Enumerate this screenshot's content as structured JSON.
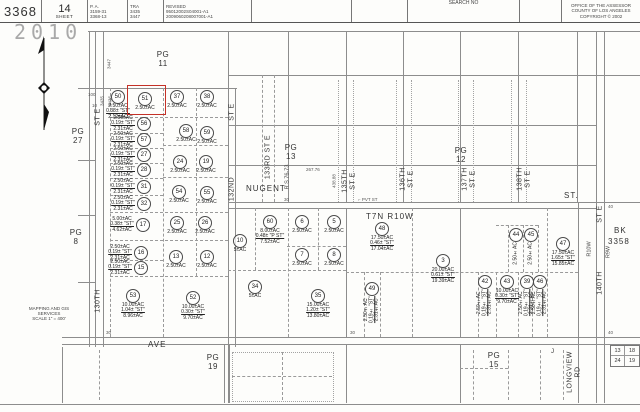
{
  "header": {
    "book": "3368",
    "sheet_num": "14",
    "sheet_word": "SHEET",
    "pa_label": "P. A.",
    "pa_lines": [
      "3159-31",
      "3368-13"
    ],
    "tra_label": "TRA",
    "tra_lines": [
      "3435",
      "3447"
    ],
    "revised_label": "REVISED",
    "revised_lines": [
      "95012002S04001-A1",
      "2009060208007001-A1"
    ],
    "search_label": "SEARCH NO",
    "office_lines": [
      "OFFICE OF THE ASSESSOR",
      "COUNTY OF LOS ANGELES",
      "COPYRIGHT © 2002"
    ]
  },
  "stamp": "2010",
  "compass_note": [
    "MAPPING AND GIS",
    "SERVICES",
    "SCALE 1\" = 400'"
  ],
  "pg_labels": [
    {
      "id": "pg-11",
      "l1": "PG",
      "l2": "11",
      "x": 163,
      "y": 50
    },
    {
      "id": "pg-27",
      "l1": "PG",
      "l2": "27",
      "x": 78,
      "y": 127
    },
    {
      "id": "pg-8",
      "l1": "PG",
      "l2": "8",
      "x": 76,
      "y": 228
    },
    {
      "id": "pg-13",
      "l1": "PG",
      "l2": "13",
      "x": 291,
      "y": 143
    },
    {
      "id": "pg-12",
      "l1": "PG",
      "l2": "12",
      "x": 461,
      "y": 146
    },
    {
      "id": "pg-19",
      "l1": "PG",
      "l2": "19",
      "x": 213,
      "y": 353
    },
    {
      "id": "pg-15",
      "l1": "PG",
      "l2": "15",
      "x": 494,
      "y": 351
    }
  ],
  "vlabels": [
    {
      "id": "130th-st-e-top",
      "lines": [
        "ST E"
      ],
      "x": 98,
      "y": 117,
      "cls": ""
    },
    {
      "id": "130th-st-e-name",
      "lines": [
        "130TH"
      ],
      "x": 98,
      "y": 301,
      "cls": ""
    },
    {
      "id": "tra-3447",
      "lines": [
        "3447"
      ],
      "x": 109,
      "y": 64,
      "cls": "tiny"
    },
    {
      "id": "tra-3435",
      "lines": [
        "3435"
      ],
      "x": 102,
      "y": 101,
      "cls": "tiny"
    },
    {
      "id": "tra-3436",
      "lines": [
        "3436"
      ],
      "x": 110,
      "y": 101,
      "cls": "tiny"
    },
    {
      "id": "132nd-st-e-top",
      "lines": [
        "ST E"
      ],
      "x": 232,
      "y": 112,
      "cls": ""
    },
    {
      "id": "132nd-st-e-name",
      "lines": [
        "132ND"
      ],
      "x": 232,
      "y": 189,
      "cls": ""
    },
    {
      "id": "133rd-st-e",
      "lines": [
        "133RD ST E"
      ],
      "x": 268,
      "y": 157,
      "cls": ""
    },
    {
      "id": "rs-76-73",
      "lines": [
        "R S 76-73"
      ],
      "x": 288,
      "y": 177,
      "cls": "small"
    },
    {
      "id": "dim-438",
      "lines": [
        "438.88"
      ],
      "x": 334,
      "y": 181,
      "cls": "tiny"
    },
    {
      "id": "135th-st-e",
      "lines": [
        "135TH",
        "ST E"
      ],
      "x": 349,
      "y": 181,
      "cls": ""
    },
    {
      "id": "136th-st-e",
      "lines": [
        "136TH",
        "ST E"
      ],
      "x": 407,
      "y": 179,
      "cls": ""
    },
    {
      "id": "137th-st-e",
      "lines": [
        "137TH",
        "ST E"
      ],
      "x": 469,
      "y": 179,
      "cls": ""
    },
    {
      "id": "138th-st-e",
      "lines": [
        "138TH",
        "ST E"
      ],
      "x": 524,
      "y": 179,
      "cls": ""
    },
    {
      "id": "140th-st-e-top",
      "lines": [
        "ST E"
      ],
      "x": 600,
      "y": 214,
      "cls": ""
    },
    {
      "id": "140th-st-e-name",
      "lines": [
        "140TH"
      ],
      "x": 600,
      "y": 283,
      "cls": ""
    },
    {
      "id": "r10w",
      "lines": [
        "R10W"
      ],
      "x": 590,
      "y": 249,
      "cls": "small"
    },
    {
      "id": "r9w",
      "lines": [
        "R9W"
      ],
      "x": 609,
      "y": 252,
      "cls": "small"
    },
    {
      "id": "longview-rd",
      "lines": [
        "LONGVIEW",
        "RD"
      ],
      "x": 574,
      "y": 372,
      "cls": ""
    }
  ],
  "hlabels": [
    {
      "id": "nugent-st",
      "text": "NUGENT",
      "x": 246,
      "y": 184,
      "cls": ""
    },
    {
      "id": "nugent-st-2",
      "text": "ST.",
      "x": 564,
      "y": 191,
      "cls": ""
    },
    {
      "id": "ave",
      "text": "AVE",
      "x": 148,
      "y": 340,
      "cls": ""
    },
    {
      "id": "t7n-r10w",
      "text": "T7N R10W",
      "x": 366,
      "y": 212,
      "cls": ""
    },
    {
      "id": "j-mark",
      "text": "J",
      "x": 551,
      "y": 349,
      "cls": "small"
    },
    {
      "id": "bk-label",
      "text": "BK",
      "x": 614,
      "y": 226,
      "cls": ""
    },
    {
      "id": "bk-number",
      "text": "3358",
      "x": 608,
      "y": 237,
      "cls": ""
    },
    {
      "id": "pvt-st",
      "text": "⌐ PVT ST",
      "x": 358,
      "y": 197,
      "cls": "tiny"
    },
    {
      "id": "dim-267",
      "text": "267.76",
      "x": 306,
      "y": 167,
      "cls": "tiny"
    },
    {
      "id": "tick-30-rs",
      "text": "30",
      "x": 284,
      "y": 197,
      "cls": "tiny"
    },
    {
      "id": "tick-40-a",
      "text": "40",
      "x": 608,
      "y": 204,
      "cls": "tiny"
    },
    {
      "id": "tick-40-b",
      "text": "40",
      "x": 608,
      "y": 330,
      "cls": "tiny"
    },
    {
      "id": "tick-30-a",
      "text": "30",
      "x": 106,
      "y": 330,
      "cls": "tiny"
    },
    {
      "id": "tick-30-b",
      "text": "30",
      "x": 350,
      "y": 330,
      "cls": "tiny"
    },
    {
      "id": "tick-100",
      "text": "100",
      "x": 88,
      "y": 92,
      "cls": "tiny"
    },
    {
      "id": "tick-10",
      "text": "10",
      "x": 92,
      "y": 103,
      "cls": "tiny"
    }
  ],
  "corner_box": {
    "tl": "13",
    "tr": "18",
    "bl": "24",
    "br": "19"
  },
  "highlight_color": "#c43127",
  "parcels": [
    {
      "n": "50",
      "cx": 118,
      "cy": 97,
      "mode": "below",
      "lines": [
        "2.50±AC",
        "0.38± \"ST\"",
        "2.12±AC"
      ]
    },
    {
      "n": "51",
      "cx": 145,
      "cy": 99,
      "mode": "below",
      "lines": [
        "2.50±AC"
      ],
      "red": [
        127,
        85,
        37,
        28
      ]
    },
    {
      "n": "37",
      "cx": 177,
      "cy": 97,
      "mode": "below",
      "lines": [
        "2.50±AC"
      ]
    },
    {
      "n": "38",
      "cx": 207,
      "cy": 97,
      "mode": "below",
      "lines": [
        "2.50±AC"
      ]
    },
    {
      "n": "56",
      "cx": 144,
      "cy": 124,
      "mode": "side",
      "lines": [
        "2.50±AC",
        "0.19± \"ST\"",
        "2.31±AC"
      ]
    },
    {
      "n": "58",
      "cx": 186,
      "cy": 131,
      "mode": "below",
      "lines": [
        "2.50±AC"
      ]
    },
    {
      "n": "59",
      "cx": 207,
      "cy": 133,
      "mode": "below",
      "lines": [
        "2.50±AC"
      ]
    },
    {
      "n": "57",
      "cx": 144,
      "cy": 140,
      "mode": "side",
      "lines": [
        "2.50±AC",
        "0.19± \"ST\"",
        "2.31±AC"
      ]
    },
    {
      "n": "27",
      "cx": 144,
      "cy": 155,
      "mode": "side",
      "lines": [
        "2.50±AC",
        "0.19± \"ST\"",
        "2.31±AC"
      ]
    },
    {
      "n": "24",
      "cx": 180,
      "cy": 162,
      "mode": "below",
      "lines": [
        "2.50±AC"
      ]
    },
    {
      "n": "19",
      "cx": 206,
      "cy": 162,
      "mode": "below",
      "lines": [
        "2.50±AC"
      ]
    },
    {
      "n": "28",
      "cx": 144,
      "cy": 170,
      "mode": "side",
      "lines": [
        "2.50±AC",
        "0.19± \"ST\"",
        "2.31±AC"
      ]
    },
    {
      "n": "31",
      "cx": 144,
      "cy": 187,
      "mode": "side",
      "lines": [
        "2.50±AC",
        "0.19± \"ST\"",
        "2.31±AC"
      ]
    },
    {
      "n": "54",
      "cx": 179,
      "cy": 192,
      "mode": "below",
      "lines": [
        "2.50±AC"
      ]
    },
    {
      "n": "55",
      "cx": 207,
      "cy": 193,
      "mode": "below",
      "lines": [
        "2.50±AC"
      ]
    },
    {
      "n": "32",
      "cx": 144,
      "cy": 204,
      "mode": "side",
      "lines": [
        "2.50±AC",
        "0.19± \"ST\"",
        "2.31±AC"
      ]
    },
    {
      "n": "17",
      "cx": 143,
      "cy": 225,
      "mode": "side",
      "lines": [
        "5.00±AC",
        "0.38± \"ST\"",
        "4.62±AC"
      ]
    },
    {
      "n": "25",
      "cx": 177,
      "cy": 223,
      "mode": "below",
      "lines": [
        "2.50±AC"
      ]
    },
    {
      "n": "26",
      "cx": 205,
      "cy": 223,
      "mode": "below",
      "lines": [
        "2.50±AC"
      ]
    },
    {
      "n": "16",
      "cx": 141,
      "cy": 253,
      "mode": "side",
      "lines": [
        "2.50±AC",
        "0.19± \"ST\"",
        "2.31±AC"
      ]
    },
    {
      "n": "13",
      "cx": 176,
      "cy": 257,
      "mode": "below",
      "lines": [
        "2.50±AC"
      ]
    },
    {
      "n": "12",
      "cx": 207,
      "cy": 257,
      "mode": "below",
      "lines": [
        "2.50±AC"
      ]
    },
    {
      "n": "15",
      "cx": 141,
      "cy": 268,
      "mode": "side",
      "lines": [
        "2.50±AC",
        "0.19± \"ST\"",
        "2.31±AC"
      ]
    },
    {
      "n": "53",
      "cx": 133,
      "cy": 296,
      "mode": "below",
      "lines": [
        "10.00±AC",
        "1.04± \"ST\"",
        "8.96±AC"
      ]
    },
    {
      "n": "52",
      "cx": 193,
      "cy": 298,
      "mode": "below",
      "lines": [
        "10.00±AC",
        "0.30± \"ST\"",
        "9.70±AC"
      ]
    },
    {
      "n": "60",
      "cx": 270,
      "cy": 222,
      "mode": "below",
      "lines": [
        "8.00±AC",
        "0.48± \"P ST\"",
        "7.52±AC"
      ]
    },
    {
      "n": "6",
      "cx": 302,
      "cy": 222,
      "mode": "below",
      "lines": [
        "2.50±AC"
      ]
    },
    {
      "n": "5",
      "cx": 334,
      "cy": 222,
      "mode": "below",
      "lines": [
        "2.50±AC"
      ]
    },
    {
      "n": "10",
      "cx": 240,
      "cy": 241,
      "mode": "below",
      "lines": [
        "5±AC"
      ]
    },
    {
      "n": "7",
      "cx": 302,
      "cy": 255,
      "mode": "below",
      "lines": [
        "2.50±AC"
      ]
    },
    {
      "n": "8",
      "cx": 334,
      "cy": 255,
      "mode": "below",
      "lines": [
        "2.50±AC"
      ]
    },
    {
      "n": "34",
      "cx": 255,
      "cy": 287,
      "mode": "below",
      "lines": [
        "5±AC"
      ]
    },
    {
      "n": "35",
      "cx": 318,
      "cy": 296,
      "mode": "below",
      "lines": [
        "15.00±AC",
        "1.20± \"ST\"",
        "13.80±AC"
      ]
    },
    {
      "n": "48",
      "cx": 382,
      "cy": 229,
      "mode": "below",
      "lines": [
        "17.50±AC",
        "0.46± \"ST\"",
        "17.04±AC"
      ]
    },
    {
      "n": "49",
      "cx": 372,
      "cy": 289,
      "mode": "vert",
      "lines": [
        "2.50±AC",
        "0.19± \"ST\"",
        "2.31±AC"
      ]
    },
    {
      "n": "3",
      "cx": 443,
      "cy": 261,
      "mode": "below",
      "lines": [
        "20.00±AC",
        "0.61± \"ST\"",
        "19.39±AC"
      ]
    },
    {
      "n": "44",
      "cx": 516,
      "cy": 235,
      "mode": "vert",
      "lines": [
        "2.50±AC"
      ]
    },
    {
      "n": "45",
      "cx": 531,
      "cy": 235,
      "mode": "vert",
      "lines": [
        "2.50±AC"
      ]
    },
    {
      "n": "47",
      "cx": 563,
      "cy": 244,
      "mode": "below",
      "lines": [
        "17.50±AC",
        "1.65± \"ST\"",
        "15.85±AC"
      ]
    },
    {
      "n": "42",
      "cx": 485,
      "cy": 282,
      "mode": "vert",
      "lines": [
        "2.50±AC",
        "0.19± \"ST\"",
        "2.31±AC"
      ]
    },
    {
      "n": "43",
      "cx": 507,
      "cy": 282,
      "mode": "below",
      "lines": [
        "10.00±AC",
        "0.30± \"ST\"",
        "9.70±AC"
      ]
    },
    {
      "n": "39",
      "cx": 527,
      "cy": 282,
      "mode": "vert",
      "lines": [
        "2.50±AC",
        "0.19± \"ST\"",
        "2.31±AC"
      ]
    },
    {
      "n": "46",
      "cx": 540,
      "cy": 282,
      "mode": "vert",
      "lines": [
        "2.50±AC",
        "0.19± \"ST\"",
        "2.31±AC"
      ]
    }
  ]
}
